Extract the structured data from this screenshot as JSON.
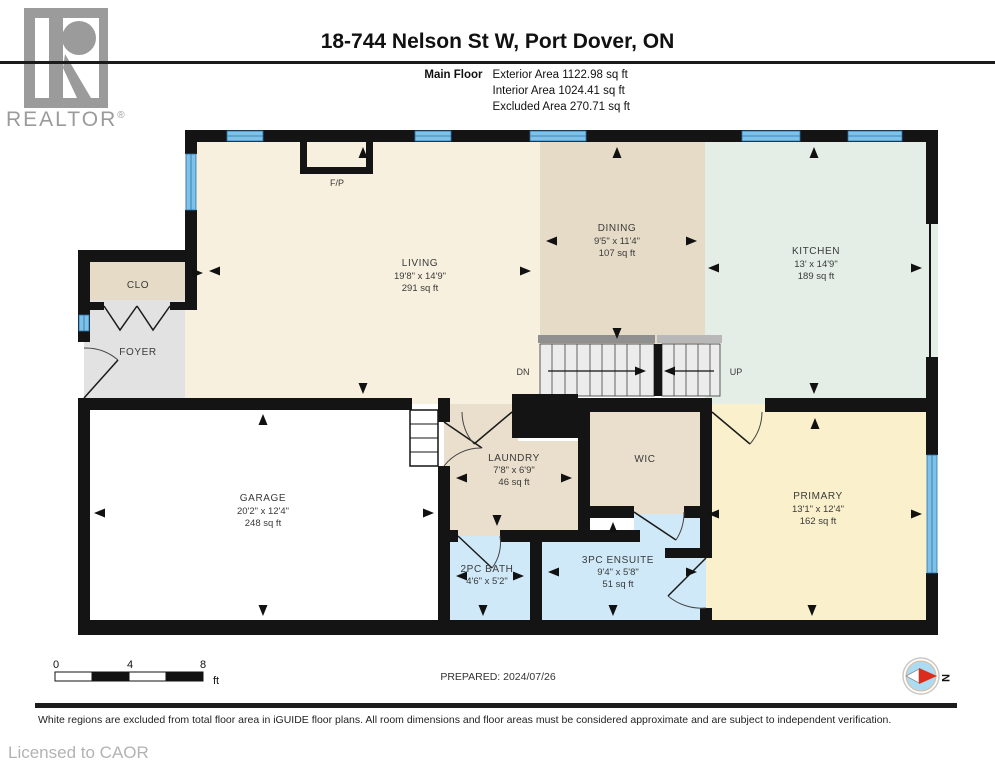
{
  "header": {
    "logo_text": "REALTOR",
    "logo_reg": "®",
    "title": "18-744 Nelson St W, Port Dover, ON",
    "floor_label": "Main Floor",
    "areas": [
      "Exterior Area 1122.98 sq ft",
      "Interior Area 1024.41 sq ft",
      "Excluded Area 270.71 sq ft"
    ]
  },
  "rooms": {
    "living": {
      "name": "LIVING",
      "dims": "19'8\" x 14'9\"",
      "area": "291 sq ft"
    },
    "dining": {
      "name": "DINING",
      "dims": "9'5\" x 11'4\"",
      "area": "107 sq ft"
    },
    "kitchen": {
      "name": "KITCHEN",
      "dims": "13' x 14'9\"",
      "area": "189 sq ft"
    },
    "closet": {
      "name": "CLO"
    },
    "foyer": {
      "name": "FOYER"
    },
    "garage": {
      "name": "GARAGE",
      "dims": "20'2\" x 12'4\"",
      "area": "248 sq ft"
    },
    "laundry": {
      "name": "LAUNDRY",
      "dims": "7'8\" x 6'9\"",
      "area": "46 sq ft"
    },
    "wic": {
      "name": "WIC"
    },
    "primary": {
      "name": "PRIMARY",
      "dims": "13'1\" x 12'4\"",
      "area": "162 sq ft"
    },
    "bath2pc": {
      "name": "2PC BATH",
      "dims": "4'6\" x 5'2\""
    },
    "ensuite3pc": {
      "name": "3PC ENSUITE",
      "dims": "9'4\" x 5'8\"",
      "area": "51 sq ft"
    }
  },
  "plan": {
    "fireplace_label": "F/P",
    "stairs": {
      "down": "DN",
      "up": "UP"
    }
  },
  "footer": {
    "scale": {
      "t0": "0",
      "t4": "4",
      "t8": "8",
      "unit": "ft"
    },
    "prepared": "PREPARED: 2024/07/26",
    "compass_n": "N",
    "disclaimer": "White regions are excluded from total floor area in iGUIDE floor plans. All room dimensions and floor areas must be considered approximate and are subject to independent verification.",
    "licensed": "Licensed to CAOR"
  },
  "colors": {
    "wall": "#141414",
    "window_blue": "#7ec2ea",
    "room_cream": "#f7f0df",
    "room_tan": "#e6dbc7",
    "room_light_tan": "#eadfcc",
    "room_green": "#e4eee6",
    "room_gray": "#e2e2e2",
    "room_yellow": "#faf0cc",
    "room_blue": "#cfe9f8",
    "compass_red": "#dd2c1c",
    "logo_gray": "#9b9b9b"
  }
}
